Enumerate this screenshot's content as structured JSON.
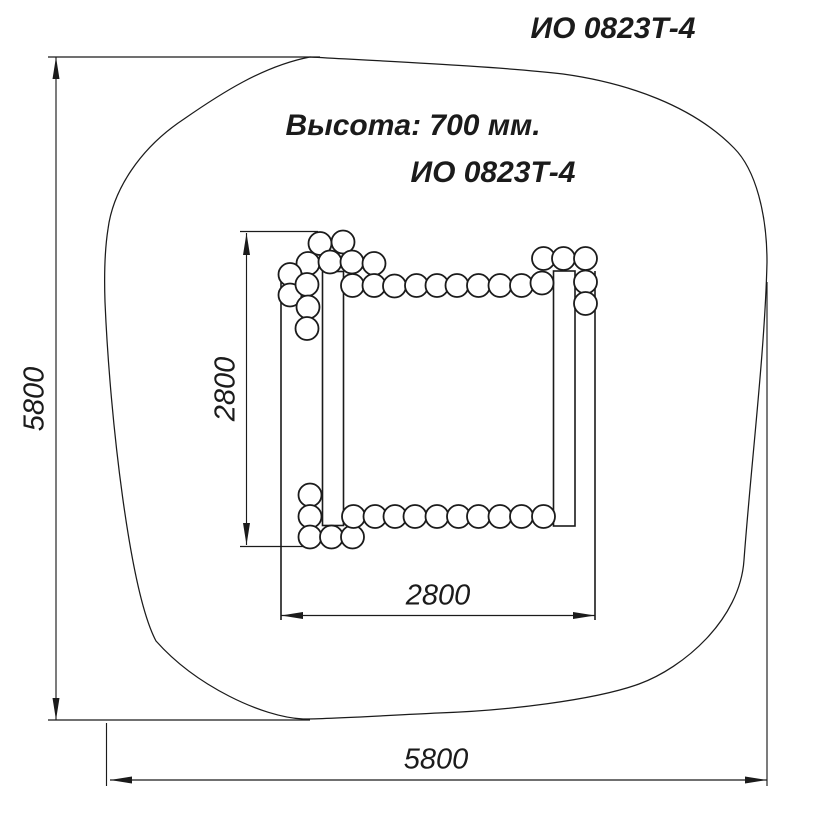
{
  "page": {
    "background": "#ffffff",
    "ink": "#1b1b1b"
  },
  "labels": {
    "corner_code": "ИО 0823Т-4",
    "height_note": "Высота: 700 мм.",
    "model_code": "ИО 0823Т-4"
  },
  "dimensions": {
    "safety_zone_height": "5800",
    "safety_zone_width": "5800",
    "frame_height": "2800",
    "frame_width": "2800"
  },
  "geometry": {
    "viewbox": "0 0 832 821",
    "safety_zone_path": "M 310,57 C 400,62 505,67 563,74 C 628,83 693,106 734,148 C 756,170 767,215 767,262 C 765,350 751,465 744,560 C 740,620 683,668 639,684 C 595,700 505,711 438,713 C 395,715 330,719 303,719 C 262,717 196,686 156,641 C 130,592 110,420 105,302 C 104,272 105,248 108,229 C 113,190 140,148 184,119 C 220,94 263,66 310,57 Z",
    "posts": [
      {
        "x": 322.5,
        "y": 271.5,
        "w": 21,
        "h": 254
      },
      {
        "x": 553.5,
        "y": 271,
        "w": 21.5,
        "h": 255
      }
    ],
    "frame_lines": [
      [
        281,
        273,
        281,
        620
      ],
      [
        595,
        271,
        595,
        620
      ]
    ],
    "ext_lines": [
      [
        48,
        57,
        320,
        57
      ],
      [
        48,
        720,
        310,
        720
      ],
      [
        106.5,
        723,
        106.5,
        786
      ],
      [
        767,
        282,
        767,
        786
      ],
      [
        240,
        231.5,
        318,
        231.5
      ],
      [
        240,
        546.5,
        316,
        546.5
      ]
    ],
    "dim_lines": [
      [
        56,
        57,
        56,
        720
      ],
      [
        110,
        780,
        767,
        780
      ],
      [
        246.5,
        233,
        246.5,
        545
      ],
      [
        281,
        615.5,
        595,
        615.5
      ]
    ],
    "arrows": [
      "56,57 52.5,79 59.5,79",
      "56,720 52.5,698 59.5,698",
      "110,780 132,776.5 132,783.5",
      "767,780 745,776.5 745,783.5",
      "246.5,233 243,255 250,255",
      "246.5,545 243,523 250,523",
      "281,615.5 303,612 303,619",
      "595,615.5 573,612 573,619"
    ],
    "log_radius": 11.5,
    "logs": [
      [
        320,
        243.5
      ],
      [
        343,
        242
      ],
      [
        308,
        263.5
      ],
      [
        330,
        262
      ],
      [
        352,
        262
      ],
      [
        374,
        263.5
      ],
      [
        290,
        274.5
      ],
      [
        290,
        295
      ],
      [
        307,
        284.5
      ],
      [
        308,
        307
      ],
      [
        307,
        328.5
      ],
      [
        352.5,
        285.5
      ],
      [
        374,
        285.5
      ],
      [
        394.5,
        286
      ],
      [
        416.5,
        285.5
      ],
      [
        437,
        285.5
      ],
      [
        457,
        285.5
      ],
      [
        478.5,
        285.5
      ],
      [
        500,
        285.5
      ],
      [
        521.5,
        285.5
      ],
      [
        542,
        283
      ],
      [
        543.5,
        258.5
      ],
      [
        563.5,
        258.5
      ],
      [
        585.5,
        258.5
      ],
      [
        585.5,
        282
      ],
      [
        585.5,
        303.5
      ],
      [
        310,
        495
      ],
      [
        310,
        516.5
      ],
      [
        310,
        537
      ],
      [
        331.5,
        537
      ],
      [
        352.5,
        537
      ],
      [
        353.5,
        516.5
      ],
      [
        375,
        516.5
      ],
      [
        395,
        516.5
      ],
      [
        415,
        516.5
      ],
      [
        437,
        516.5
      ],
      [
        458.5,
        516.5
      ],
      [
        478.5,
        516.5
      ],
      [
        500,
        516.5
      ],
      [
        521.5,
        516.5
      ],
      [
        543.5,
        516.5
      ]
    ]
  }
}
